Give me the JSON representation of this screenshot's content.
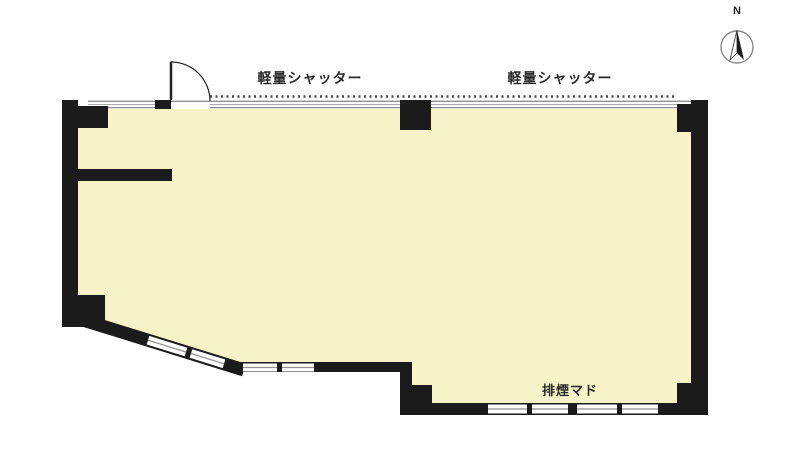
{
  "plan": {
    "labels": {
      "shutter_left": "軽量シャッター",
      "shutter_right": "軽量シャッター",
      "smoke_window": "排煙マド",
      "north": "N"
    },
    "colors": {
      "background": "#ffffff",
      "wall": "#1b1b1b",
      "floor": "#f7f3c8",
      "window_frame": "#8f8f8f",
      "shutter_dotted": "#4a4a4a",
      "label_text": "#2a2a2a"
    }
  }
}
